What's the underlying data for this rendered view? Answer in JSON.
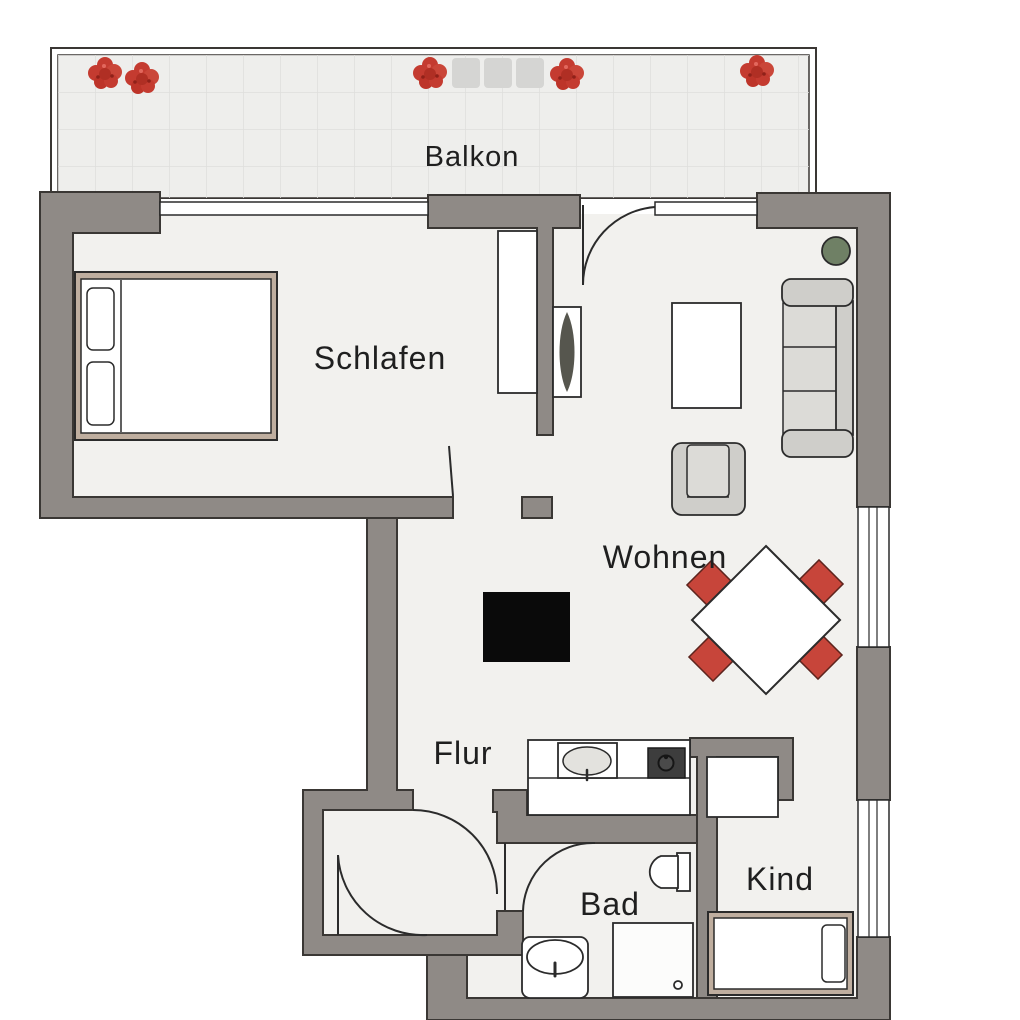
{
  "page": {
    "type": "floor-plan",
    "description": "apartment floor plan"
  },
  "rooms": {
    "balkon": {
      "label": "Balkon"
    },
    "schlafen": {
      "label": "Schlafen"
    },
    "wohnen": {
      "label": "Wohnen"
    },
    "flur": {
      "label": "Flur"
    },
    "bad": {
      "label": "Bad"
    },
    "kind": {
      "label": "Kind"
    }
  },
  "furniture": [
    {
      "name": "flower-boxes",
      "room": "balkon",
      "count": 5
    },
    {
      "name": "balcony-pads",
      "room": "balkon",
      "count": 3
    },
    {
      "name": "double-bed-with-two-pillows",
      "room": "schlafen"
    },
    {
      "name": "built-in-wardrobe",
      "room": "schlafen"
    },
    {
      "name": "sideboard-with-plant",
      "room": "wohnen"
    },
    {
      "name": "potted-plant",
      "room": "wohnen"
    },
    {
      "name": "three-seat-sofa",
      "room": "wohnen"
    },
    {
      "name": "coffee-table",
      "room": "wohnen"
    },
    {
      "name": "armchair",
      "room": "wohnen"
    },
    {
      "name": "dining-table-with-4-red-chairs",
      "room": "wohnen"
    },
    {
      "name": "black-cabinet",
      "room": "flur"
    },
    {
      "name": "kitchenette-counter-sink-cooktop",
      "room": "flur"
    },
    {
      "name": "toilet",
      "room": "bad"
    },
    {
      "name": "washbasin",
      "room": "bad"
    },
    {
      "name": "shower",
      "room": "bad"
    },
    {
      "name": "wardrobe",
      "room": "kind"
    },
    {
      "name": "single-bed-with-pillow",
      "room": "kind"
    }
  ],
  "colors": {
    "wall": "#8f8a86",
    "wall_outline": "#3a3734",
    "floor": "#f2f1ee",
    "balcony_floor": "#eeeeec",
    "tile_line": "#dededc",
    "furniture_mid": "#cfceca",
    "furniture_light": "#dcdbd7",
    "bed_frame": "#bfae9f",
    "chair_red": "#c7453a",
    "flower_red": "#c43b30",
    "plant_green": "#6f8065",
    "appliance_dark": "#3d3d3d",
    "black_item": "#0a0a0a",
    "label": "#1f1f1f",
    "line": "#2b2b2b"
  }
}
